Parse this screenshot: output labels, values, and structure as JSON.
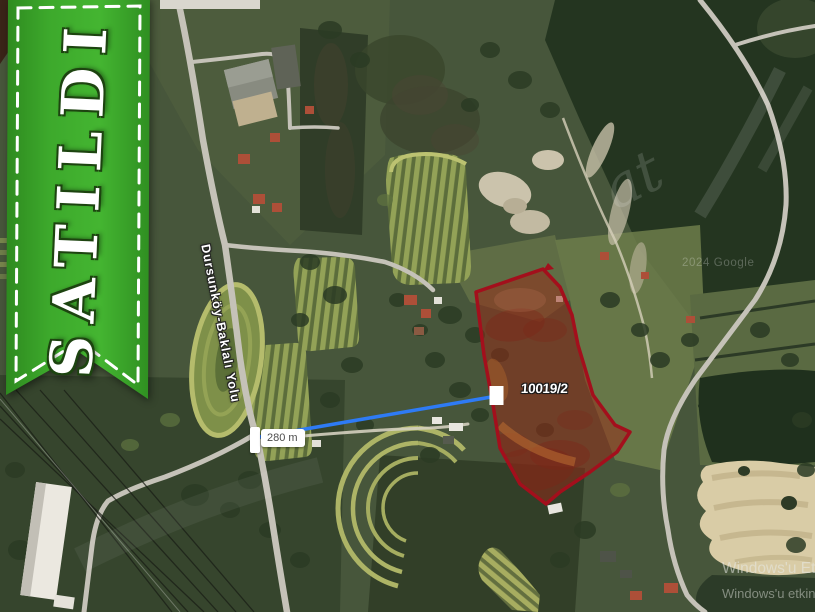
{
  "sold_ribbon": {
    "label": "SATILDI",
    "green": "#38a42a"
  },
  "map": {
    "road_label": "Dursunköy-Baklalı Yolu",
    "parcel": {
      "label": "10019/2",
      "border_color": "#a30f1c"
    },
    "measurement": {
      "label": "280 m",
      "line_color": "#2e7bf5"
    },
    "attribution": "2024 Google",
    "watermark_fragment": "at"
  },
  "os_watermark": {
    "line1": "Windows'u Et",
    "line2": "Windows'u etkinle"
  }
}
